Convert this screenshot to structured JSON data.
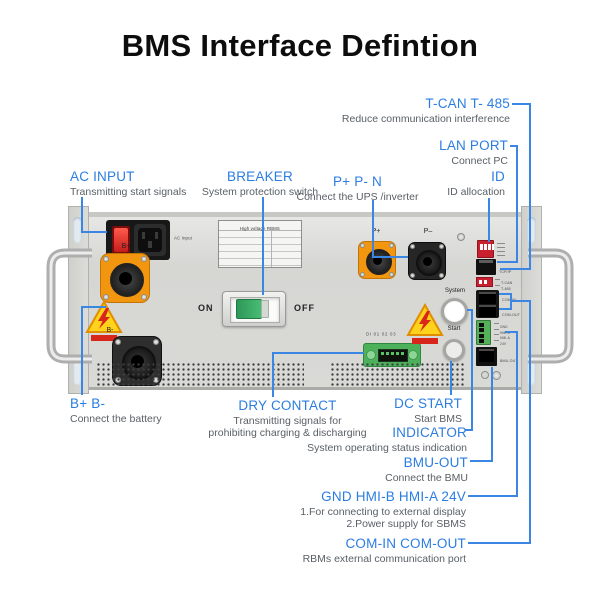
{
  "title": "BMS Interface Defintion",
  "colors": {
    "accent_blue": "#2b7de2",
    "line_blue": "#3a86e2",
    "desc_gray": "#5a6066",
    "warning_yellow": "#ffd21c",
    "warning_red": "#d8261a",
    "connector_orange": "#f2960f"
  },
  "callouts": {
    "tcan": {
      "label": "T-CAN T- 485",
      "desc": "Reduce communication interference"
    },
    "lan": {
      "label": "LAN PORT",
      "desc": "Connect PC"
    },
    "id": {
      "label": "ID",
      "desc": "ID allocation"
    },
    "ac": {
      "label": "AC INPUT",
      "desc": "Transmitting start signals"
    },
    "breaker": {
      "label": "BREAKER",
      "desc": "System protection switch"
    },
    "p": {
      "label": "P+ P- N",
      "desc": "Connect the UPS /inverter"
    },
    "b": {
      "label": "B+ B-",
      "desc": "Connect the battery"
    },
    "dry": {
      "label": "DRY CONTACT",
      "desc1": "Transmitting signals for",
      "desc2": "prohibiting charging & discharging"
    },
    "dc": {
      "label": "DC START",
      "desc": "Start BMS"
    },
    "indicator": {
      "label": "INDICATOR",
      "desc": "System operating status indication"
    },
    "bmu": {
      "label": "BMU-OUT",
      "desc": "Connect the BMU"
    },
    "gnd": {
      "label": "GND HMI-B HMI-A 24V",
      "desc1": "1.For connecting to external display",
      "desc2": "2.Power supply for SBMS"
    },
    "com": {
      "label": "COM-IN COM-OUT",
      "desc": "RBMs external communication port"
    }
  },
  "device": {
    "ac_input": "AC Input",
    "sticker_title": "High voltage RBMS",
    "b_plus": "B+",
    "b_minus": "B-",
    "p_plus": "P+",
    "p_minus": "P–",
    "on": "ON",
    "off": "OFF",
    "system": "System",
    "start": "Start",
    "dry_contact": "DI 01 02 03",
    "ports": {
      "tcpip": "TCP/IP",
      "tcan": "T-CAN",
      "t485": "T-485",
      "com_in": "COM-IN",
      "com_out": "COM-OUT",
      "gnd": "GND",
      "hmi_b": "HMI-B",
      "hmi_a": "HMI-A",
      "v24": "24V",
      "bmu_out": "BMU-OUT"
    }
  }
}
